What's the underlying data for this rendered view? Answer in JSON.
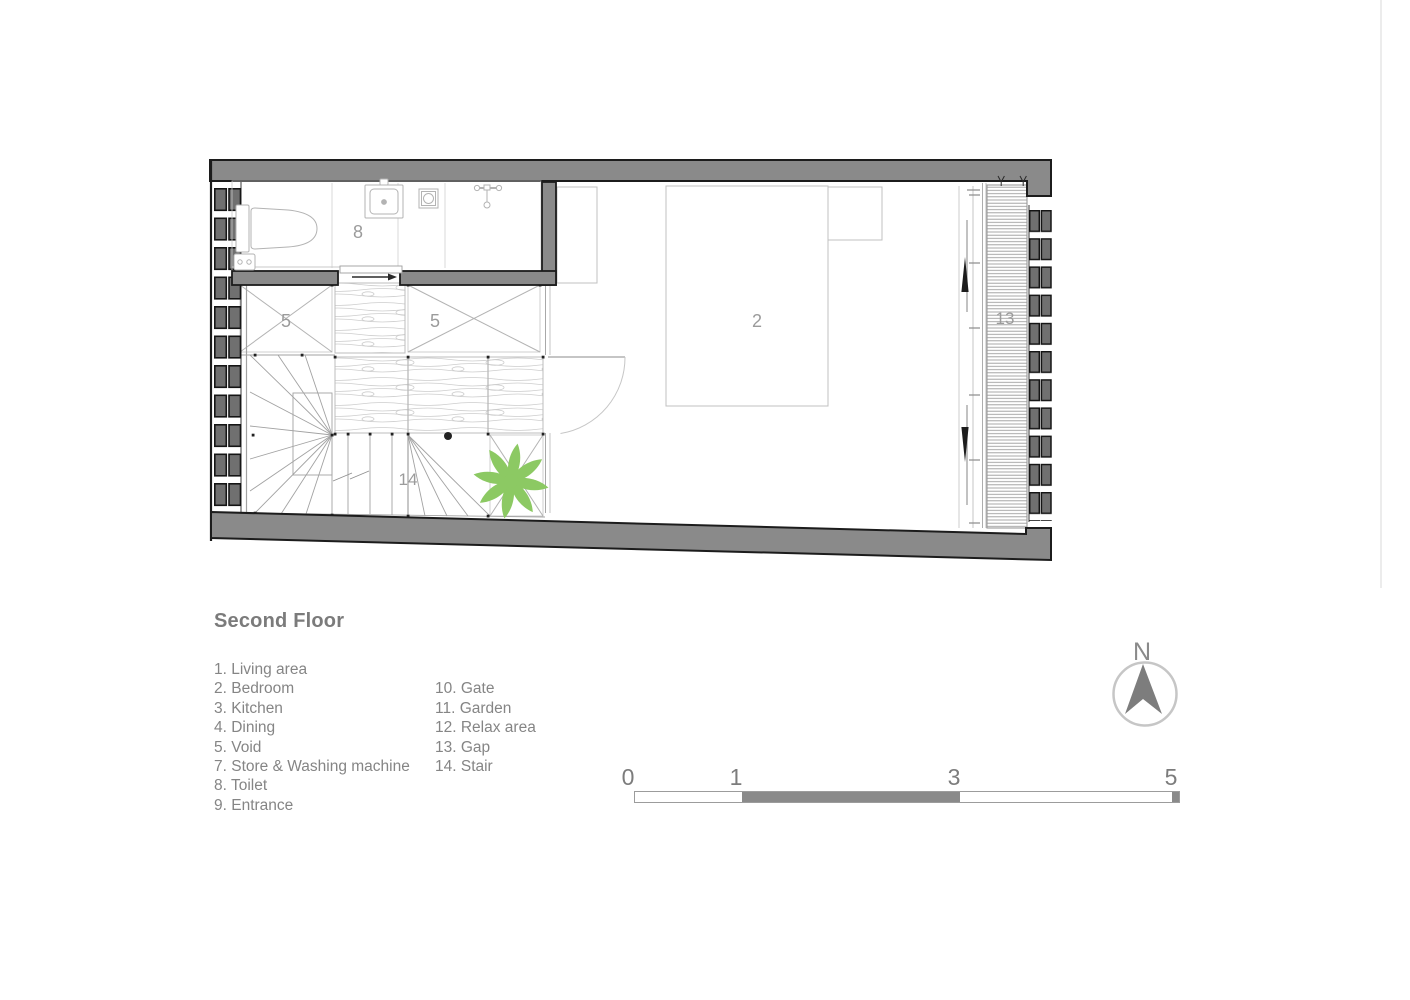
{
  "title": "Second Floor",
  "legend": {
    "column1": [
      "1. Living area",
      "2. Bedroom",
      "3. Kitchen",
      "4. Dining",
      "5. Void",
      "7. Store & Washing machine",
      "8. Toilet",
      "9. Entrance"
    ],
    "column2": [
      "10. Gate",
      "11. Garden",
      "12. Relax area",
      "13. Gap",
      "14. Stair"
    ]
  },
  "plan": {
    "labels": {
      "toilet": "8",
      "void_left": "5",
      "void_right": "5",
      "bedroom": "2",
      "gap": "13",
      "stair": "14"
    },
    "colors": {
      "wall_fill": "#8a8a8a",
      "brick_fill": "#707070",
      "outline": "#1c1c1c",
      "thin_line": "#c0c0c0",
      "label_gray": "#9b9b9b",
      "plant_green": "#8cc963"
    }
  },
  "north": {
    "label": "N"
  },
  "scale_bar": {
    "ticks": [
      "0",
      "1",
      "3",
      "5"
    ]
  }
}
